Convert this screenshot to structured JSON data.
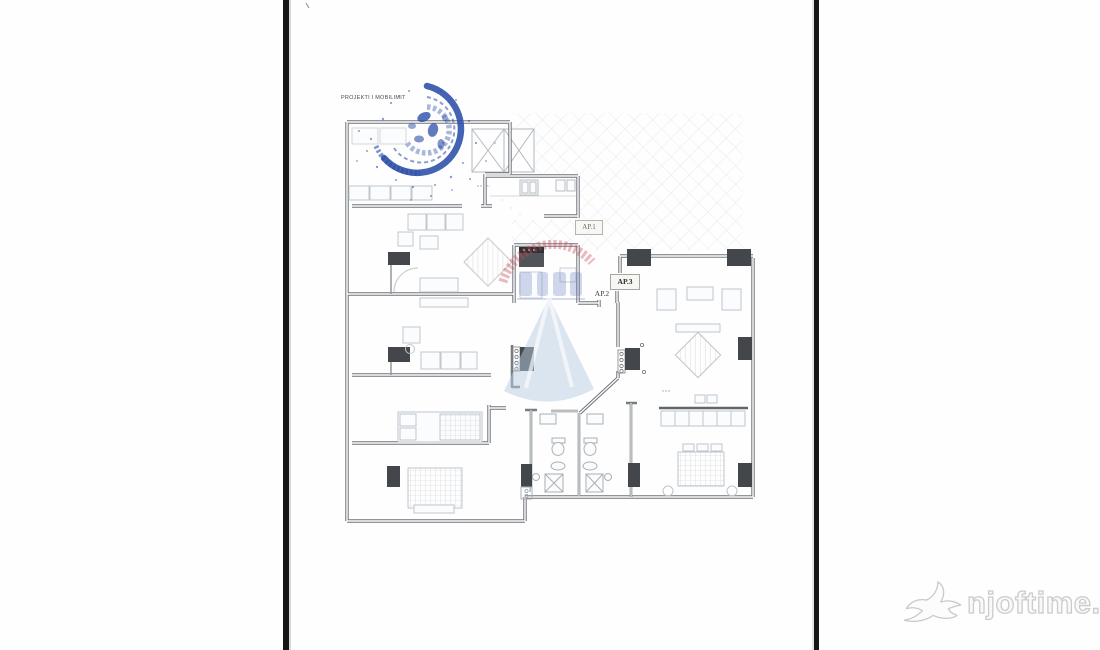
{
  "document": {
    "drawing_label": "PROJEKTI I MOBILIMIT",
    "kind": "apartment-floor-plan-scan"
  },
  "plan": {
    "apartment_labels": {
      "ap1": "AP.1",
      "ap2": "AP.2",
      "ap3": "AP.3"
    }
  },
  "stamp": {
    "type": "circular-ink-stamp",
    "color": "#2b4da8"
  },
  "site_watermark": {
    "text": "njoftime.al",
    "icon": "swallow-bird-icon"
  },
  "colors": {
    "wall_gray": "#6e7378",
    "column_dark": "#43464a",
    "furniture_gray": "#c2c8cd",
    "hatch_gray": "#c9cfd4",
    "stamp_blue": "#2b4da8",
    "watermark_red": "#c84a56",
    "watermark_blue": "#b7cbe0",
    "border_black": "#161616",
    "site_watermark_gray": "#cccccc"
  }
}
